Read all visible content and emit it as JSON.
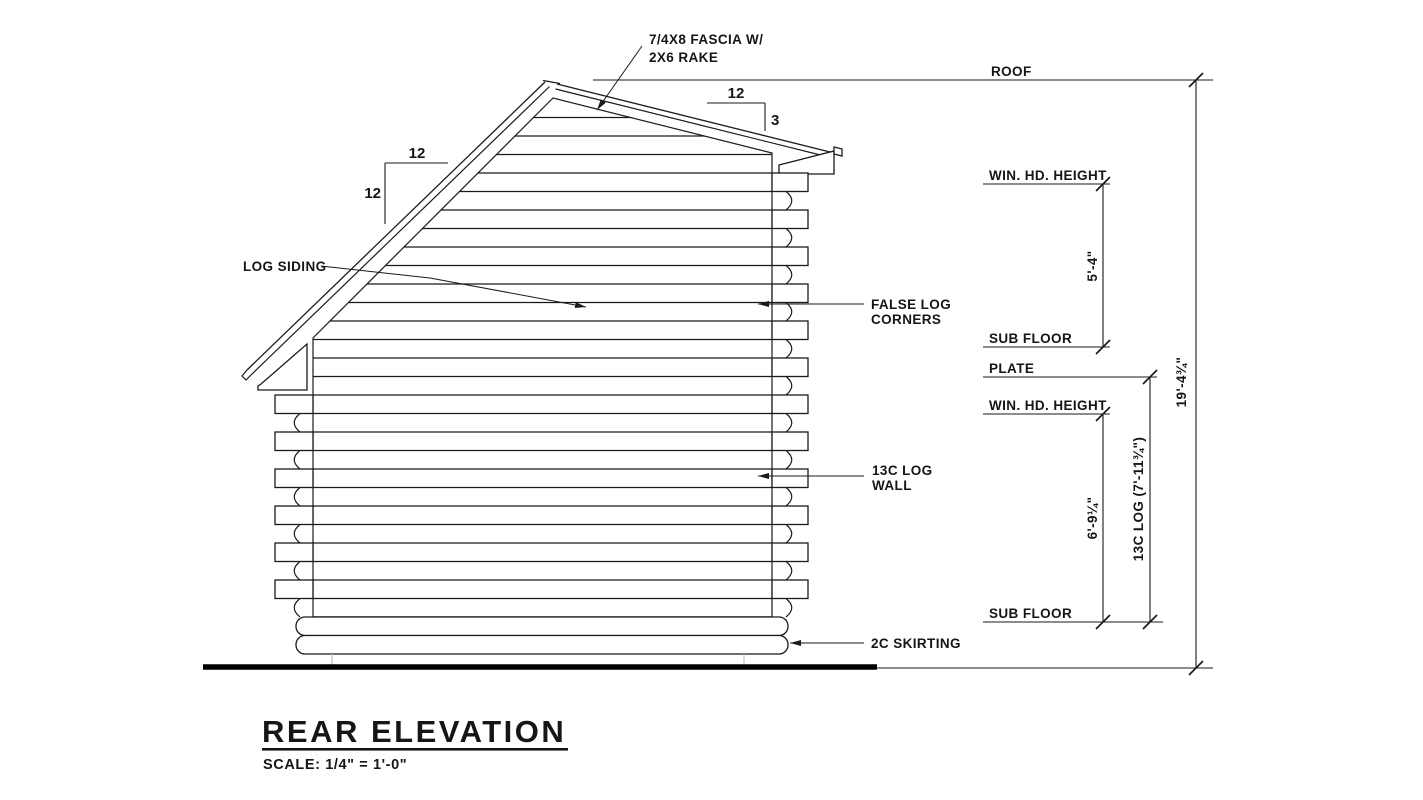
{
  "annotations": {
    "fascia_1": "7/4X8 FASCIA W/",
    "fascia_2": "2X6 RAKE",
    "log_siding": "LOG SIDING",
    "false_corners_1": "FALSE LOG",
    "false_corners_2": "CORNERS",
    "log_wall_1": "13C LOG",
    "log_wall_2": "WALL",
    "skirting": "2C SKIRTING"
  },
  "slopes": {
    "left_run": "12",
    "left_rise": "12",
    "right_run": "12",
    "right_rise": "3"
  },
  "levels": {
    "roof": "ROOF",
    "win_hd_upper": "WIN. HD. HEIGHT",
    "sub_floor_upper": "SUB FLOOR",
    "plate": "PLATE",
    "win_hd_lower": "WIN. HD. HEIGHT",
    "sub_floor_lower": "SUB FLOOR"
  },
  "dimensions": {
    "win_to_subfloor_upper": "5'-4\"",
    "win_to_subfloor_lower": "6'-9¼\"",
    "log_wall_height": "13C LOG (7'-11¾\")",
    "overall_height": "19'-4¾\""
  },
  "title_block": {
    "title": "REAR ELEVATION",
    "scale": "SCALE: 1/4\" = 1'-0\""
  },
  "colors": {
    "line": "#1a1a1a",
    "ground": "#000000",
    "faint": "#c0c0c0",
    "background": "#ffffff"
  }
}
